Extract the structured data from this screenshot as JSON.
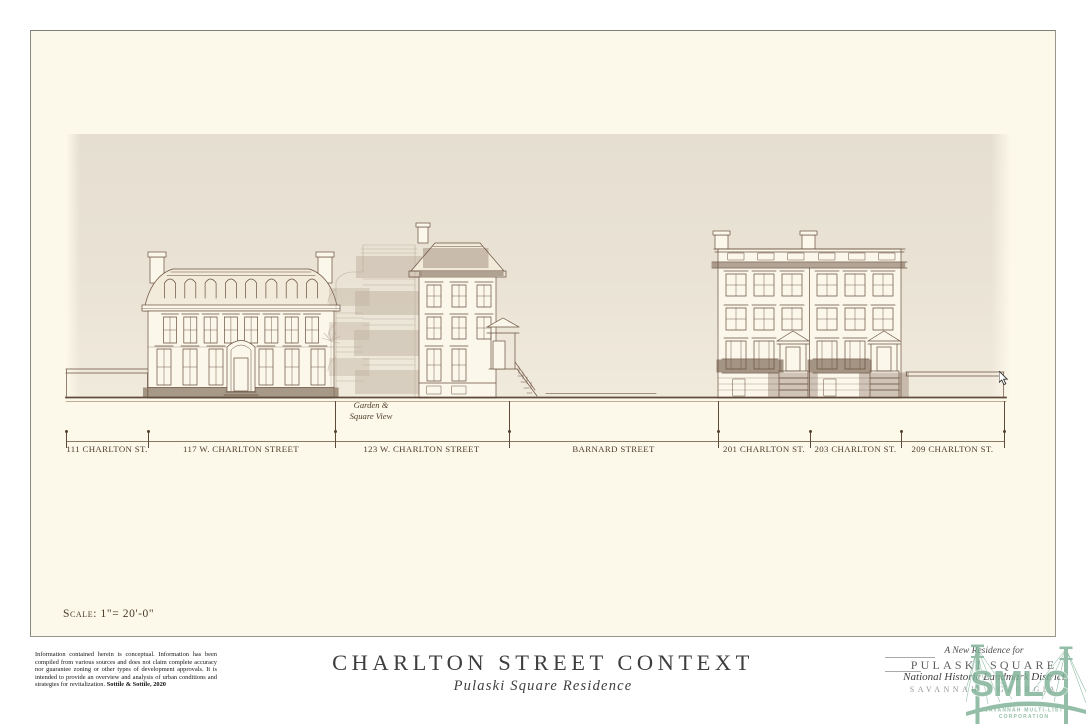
{
  "drawing": {
    "scale_label": "Scale: 1\"= 20'-0\"",
    "garden_note": [
      "Garden &",
      "Square View"
    ],
    "segments": [
      {
        "label": "111 CHARLTON ST."
      },
      {
        "label": "117 W. CHARLTON STREET"
      },
      {
        "label": "123 W. CHARLTON STREET"
      },
      {
        "label": "BARNARD STREET"
      },
      {
        "label": "201 CHARLTON ST."
      },
      {
        "label": "203 CHARLTON ST."
      },
      {
        "label": "209 CHARLTON ST."
      }
    ]
  },
  "title_block": {
    "disclaimer_text": "Information contained herein is conceptual. Information has been compiled from various sources and does not claim complete accuracy nor guarantee zoning or other types of development approvals.  It is intended to provide an overview and analysis of urban conditions and strategies for revitalization. ",
    "disclaimer_credit": "Sottile & Sottile, 2020",
    "title": "CHARLTON STREET CONTEXT",
    "subtitle": "Pulaski Square Residence",
    "project": {
      "dedication": "A New Residence for",
      "name": "PULASKI SQUARE",
      "district": "National Historic Landmark District",
      "city": "SAVANNAH · GEORGIA"
    }
  },
  "watermark": {
    "acronym": "SMLC",
    "caption_line1": "SAVANNAH MULTI-LIST",
    "caption_line2": "CORPORATION"
  },
  "colors": {
    "sheet": "#FCF8EA",
    "band_top": "#E6DFD1",
    "ink": "#6B5140",
    "watermark_green": "#7FB297"
  }
}
